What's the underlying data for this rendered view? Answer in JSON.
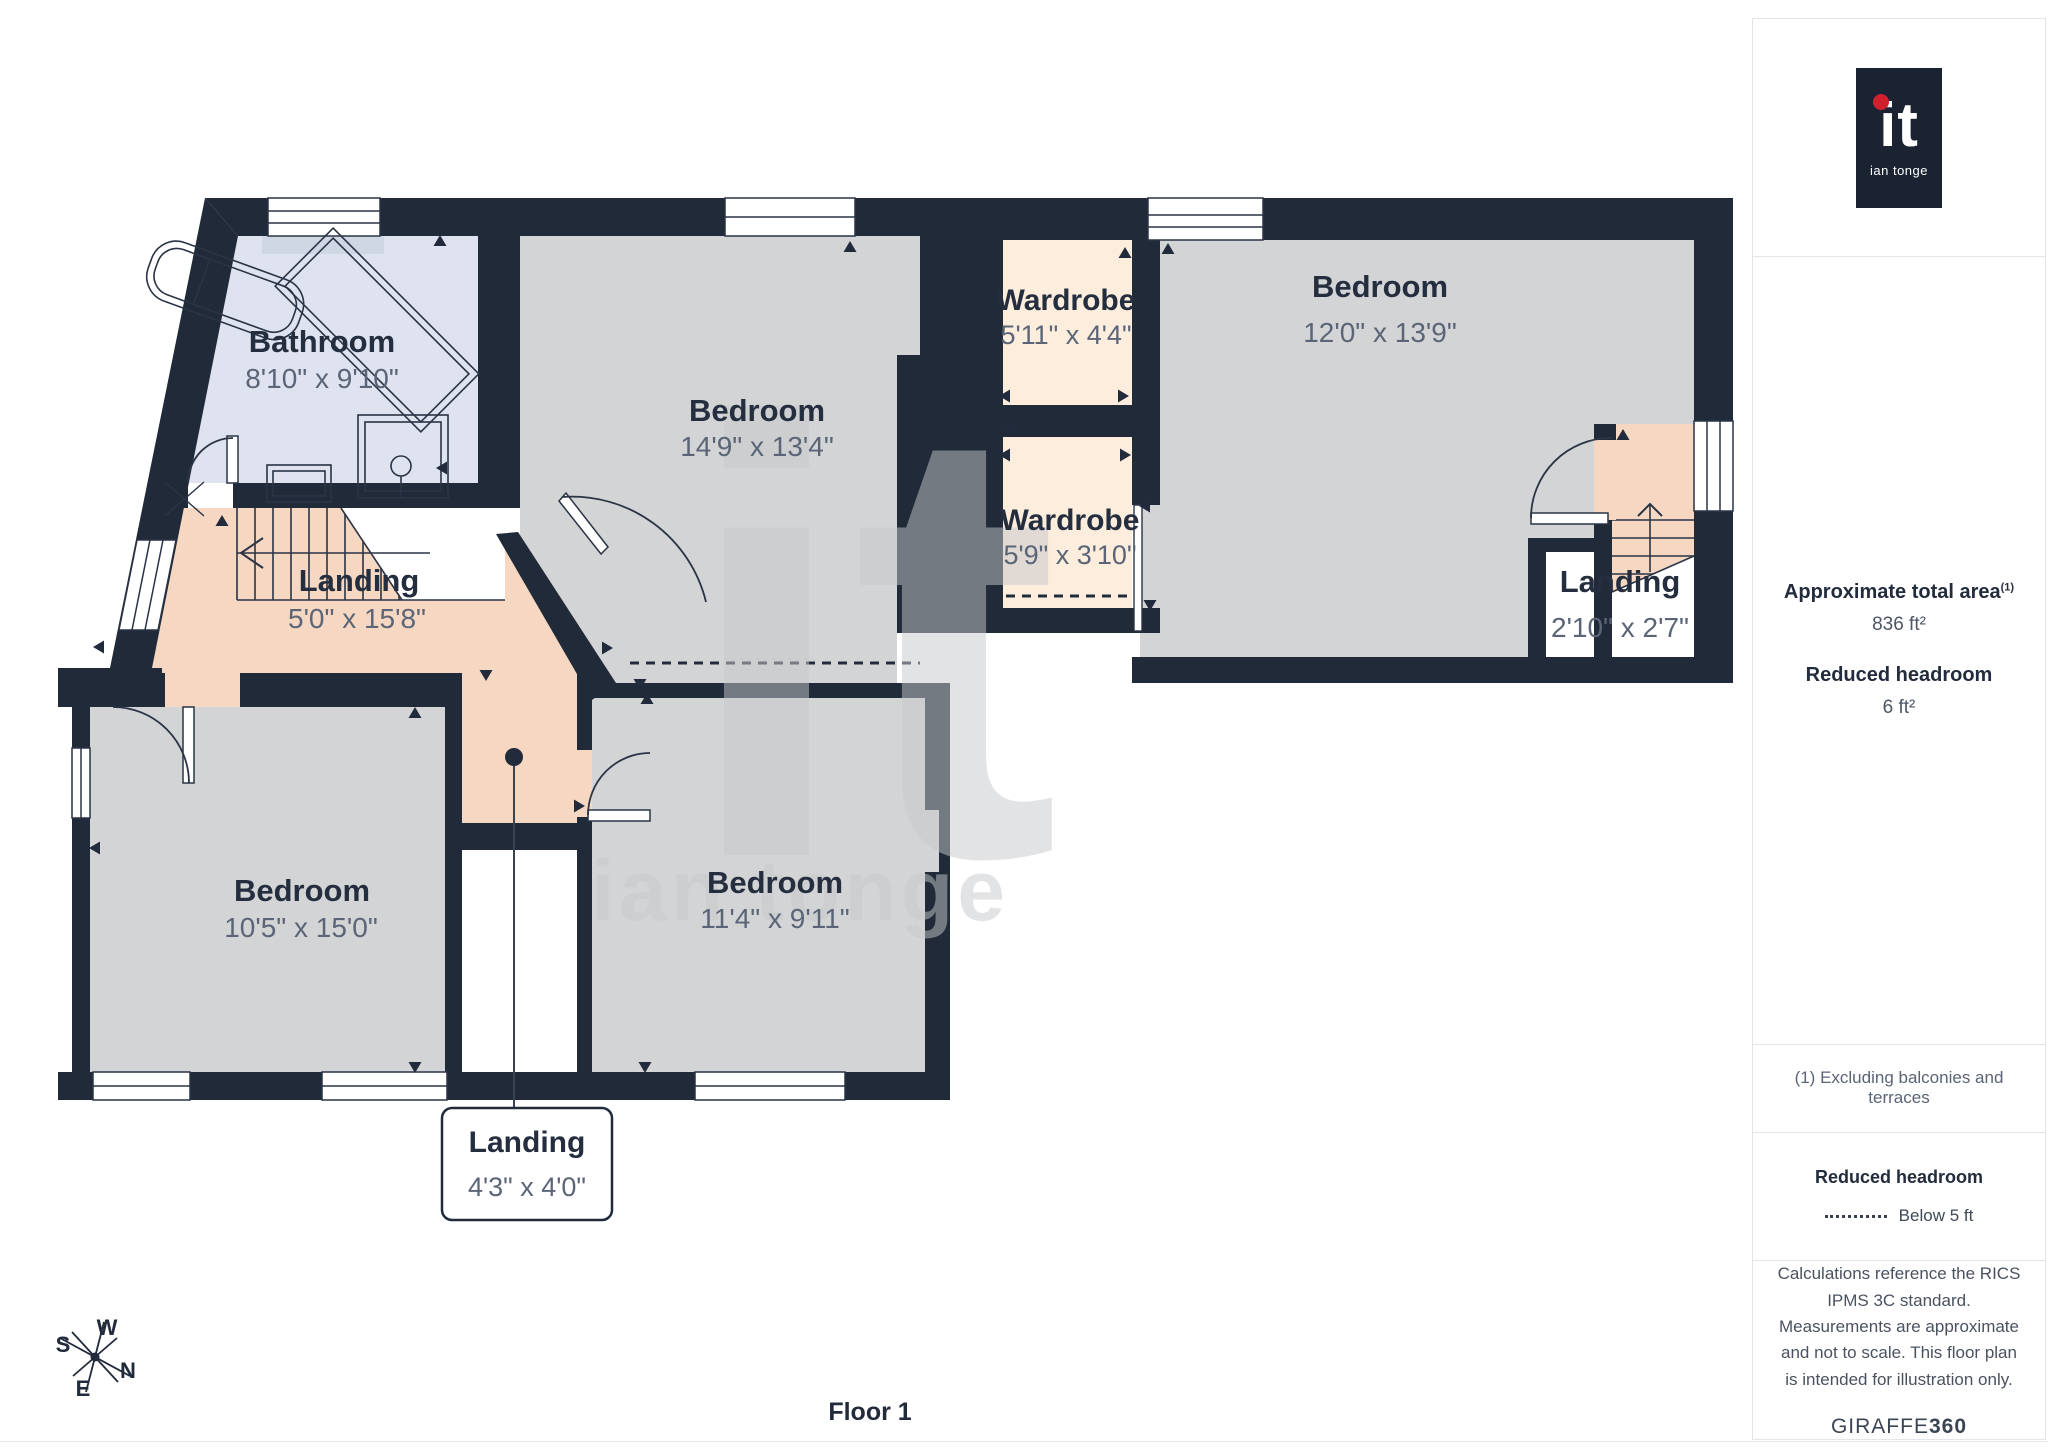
{
  "plan": {
    "floor_label": "Floor 1",
    "rooms": {
      "bathroom": {
        "name": "Bathroom",
        "dims": "8'10\" x 9'10\""
      },
      "bedroom_main": {
        "name": "Bedroom",
        "dims": "14'9\" x 13'4\""
      },
      "wardrobe_a": {
        "name": "Wardrobe",
        "dims": "5'11\" x 4'4\""
      },
      "bedroom_right": {
        "name": "Bedroom",
        "dims": "12'0\" x 13'9\""
      },
      "wardrobe_b": {
        "name": "Wardrobe",
        "dims": "5'9\" x 3'10\""
      },
      "landing_main": {
        "name": "Landing",
        "dims": "5'0\" x 15'8\""
      },
      "landing_right": {
        "name": "Landing",
        "dims": "2'10\" x 2'7\""
      },
      "bedroom_left": {
        "name": "Bedroom",
        "dims": "10'5\" x 15'0\""
      },
      "bedroom_mid": {
        "name": "Bedroom",
        "dims": "11'4\" x 9'11\""
      },
      "landing_small": {
        "name": "Landing",
        "dims": "4'3\" x 4'0\""
      }
    },
    "compass": {
      "n": "N",
      "s": "S",
      "e": "E",
      "w": "W"
    },
    "watermark": {
      "glyph": "it",
      "wordmark": "ian tonge"
    }
  },
  "sidebar": {
    "logo": {
      "glyph": "it",
      "name": "ian tonge"
    },
    "area": {
      "title": "Approximate total area",
      "note_marker": "(1)",
      "value": "836 ft²"
    },
    "headroom": {
      "title": "Reduced headroom",
      "value": "6 ft²"
    },
    "footnote": "(1) Excluding balconies and terraces",
    "legend": {
      "title": "Reduced headroom",
      "item": "Below 5 ft"
    },
    "disclaimer": "Calculations reference the RICS IPMS 3C standard. Measurements are approximate and not to scale. This floor plan is intended for illustration only.",
    "brand": {
      "name": "GIRAFFE",
      "number": "360"
    }
  },
  "colors": {
    "wall": "#212A38",
    "room_gray": "#D3D4D6",
    "bathroom_blue": "#DEE3EF",
    "corridor_peach": "#F5D7C2",
    "wardrobe_cream": "#FCEDDD",
    "logo_accent_red": "#D0202E"
  }
}
